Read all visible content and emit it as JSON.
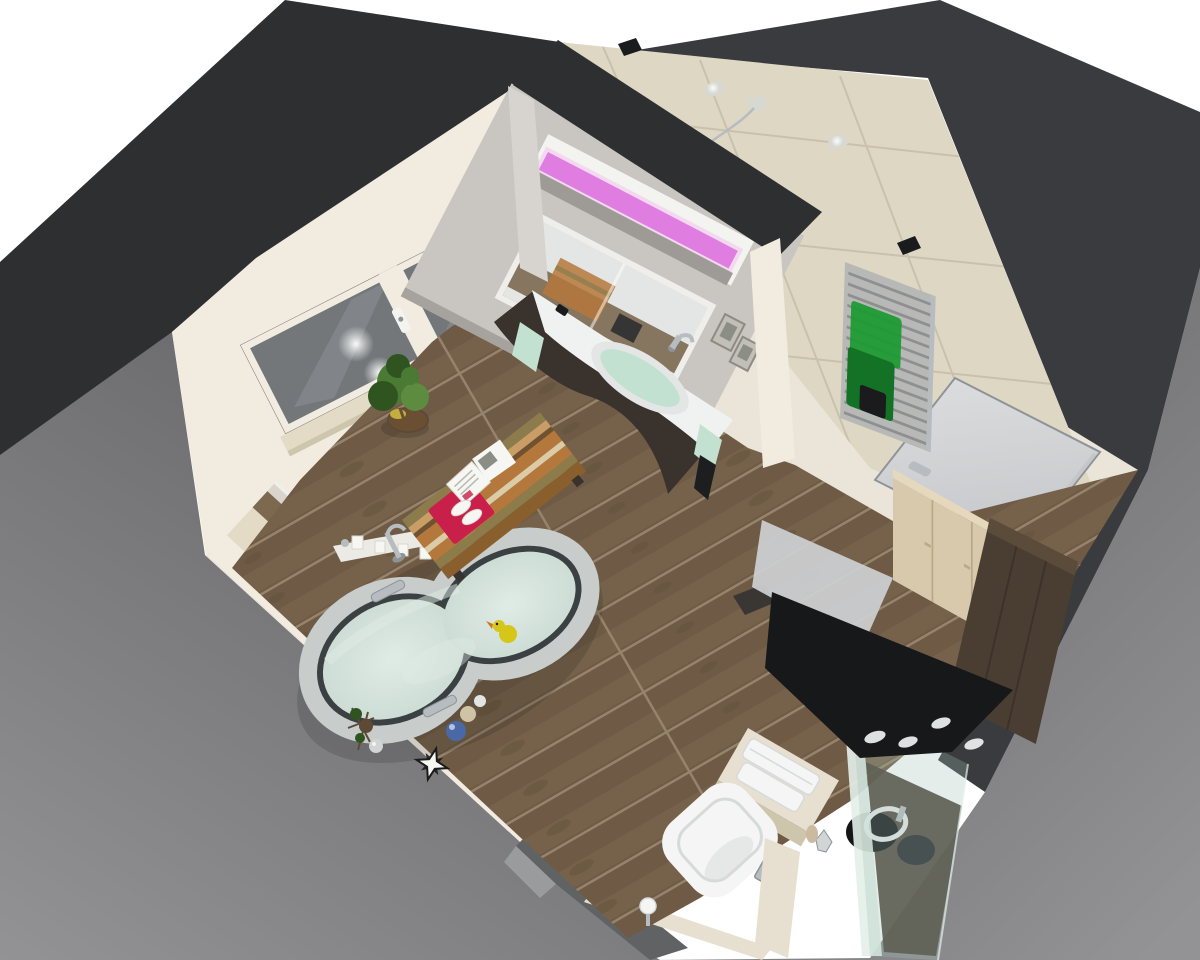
{
  "scene": {
    "type": "3d-room-render",
    "description": "Bird's-eye isometric 3D rendering of a modern bathroom interior (CAD visualization)",
    "room": "bathroom",
    "view": "top-down oblique",
    "objects": [
      "freestanding bathtub with water and yellow rubber duck",
      "wood plank floor",
      "vanity cabinet with curved dark front and white counter basin",
      "mirror cabinet with pink LED light strip",
      "partition wall",
      "two large windows with white frames",
      "striped bench cushion with red towel and open magazine",
      "potted green plant",
      "towel radiator with green towels",
      "interior door with chrome handle",
      "wall-hung toilet with towel stack and flush plate",
      "toilet paper holder",
      "glass shower enclosure with black canopy spotlights",
      "dark brown wardrobe",
      "beige cabinet",
      "window sill with candles and brass sphere",
      "decorative star ornament and dried branches",
      "blue and tan decorative balls",
      "beige tiled walls",
      "dark charcoal wall tops",
      "gray exterior walls"
    ]
  },
  "colors": {
    "bg": "#ffffff",
    "ext_gray_dark": "#636366",
    "ext_gray": "#77787b",
    "ext_gray_light": "#939396",
    "band_dark": "#2e2f31",
    "band_dark2": "#3a3b3e",
    "cream": "#eae4d9",
    "cream_light": "#f1ebe0",
    "tile": "#ded7c4",
    "grout": "#c6bfa9",
    "ledge": "#e3dbc6",
    "ledge_dark": "#cec5ad",
    "step_gray": "#d9d5cd",
    "step_white": "#efefec",
    "wood": "#6f5b45",
    "wood_light": "#7d6950",
    "wood_gap": "#95836b",
    "wood_knot": "#5c4a37",
    "glass_win": "#73777a",
    "glass_win_light": "#909497",
    "partition_gray": "#c9c5c1",
    "partition_end": "#d7d4d0",
    "niche_white": "#f3f3f0",
    "niche_shadow": "#9e9a95",
    "led_pink": "#df7de0",
    "led_glow": "#f0aaf0",
    "mirror": "#e3e6e5",
    "mirror_frame": "#efeeea",
    "mirror_wood": "#7b6850",
    "vanity_dark": "#3a332d",
    "counter": "#f0f2f1",
    "basin_water": "#c2e1d1",
    "basin_dark_towel": "#1d1e1f",
    "chrome": "#b6bcbf",
    "chrome_dark": "#8d9396",
    "bench_orange": "#b5783c",
    "bench_tan": "#c99e66",
    "bench_olive": "#8c7b4b",
    "bench_cream": "#dbcba7",
    "bench_brown": "#6f5230",
    "bench_wood": "#8a5f2e",
    "towel_red": "#c8204a",
    "card_white": "#f6f6f2",
    "page_line": "#b9b9b0",
    "art_gray": "#8a8e84",
    "frame_gray": "#c2beb8",
    "frame_edge": "#8e8a84",
    "plant": "#4a7a33",
    "plant_dark": "#2f5420",
    "plant_light": "#5d8c40",
    "pot": "#6b4f33",
    "pot_yellow": "#c4ae3e",
    "tub_rim": "#c8ccca",
    "tub_inner": "#3b4042",
    "water": "#cdddd6",
    "water_light": "#e0ebe5",
    "duck": "#d6c619",
    "duck_beak": "#d07818",
    "ball_blue": "#4a68a6",
    "ball_tan": "#cfc3a6",
    "ball_white": "#e2e5e5",
    "brass": "#ab8f50",
    "towel_green": "#1f9a33",
    "towel_green_dark": "#147226",
    "towel_black": "#1b1b1d",
    "radiator": "#b8b9b7",
    "radiator_slat": "#8e8f91",
    "door": "#dadcde",
    "door_dark": "#c4c6c9",
    "toilet": "#f4f5f4",
    "toilet_shade": "#d7dada",
    "halfwall": "#e7e0d1",
    "cab_beige": "#d8c8ac",
    "cab_beige_top": "#e5d8bd",
    "cab_seam": "#b9a987",
    "wardrobe": "#4a3e33",
    "wardrobe_top": "#5a4b3b",
    "wardrobe_dark": "#3b322a",
    "canopy": "#17181a",
    "spot": "#e9ecec",
    "glassp": "#9fbfb4",
    "glass_edge": "#e4f0ea",
    "shower_floor": "#493d31",
    "basin_black": "#141517",
    "ring_white": "#e8eaea",
    "drum": "#27282b",
    "crinkle": "#d2d5d5",
    "statue": "#cbb9a0",
    "tray": "#cbced0",
    "mat": "#3a3634",
    "black_sq": "#1a1b1d",
    "lit_sq": "#d8d8d3",
    "slab_gray": "#606264",
    "slab_light": "#a0a2a4",
    "shelf_white": "#eceae4",
    "shadow": "#000000",
    "glare": "#ffffff"
  }
}
